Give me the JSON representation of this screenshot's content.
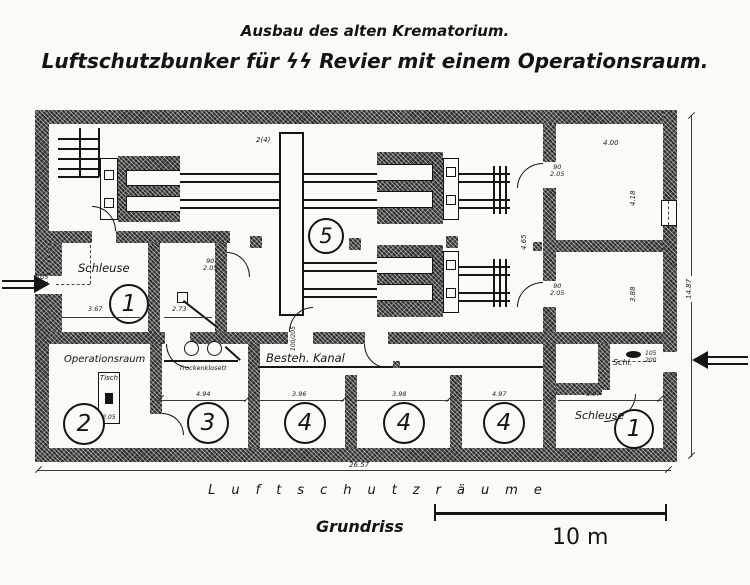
{
  "title": {
    "line1": "Ausbau des alten Krematorium.",
    "line2": "Luftschutzbunker für ϟϟ Revier mit einem Operationsraum."
  },
  "plan": {
    "rooms": [
      {
        "id": "schleuse-left",
        "label": "Schleuse",
        "number": "1",
        "dim": "3.67"
      },
      {
        "id": "operationsraum",
        "label": "Operationsraum",
        "number": "2",
        "furniture": "Tisch",
        "furniture_dim": "2.05"
      },
      {
        "id": "trockenklosett",
        "label": "Trockenklosett",
        "number": "3",
        "dim": "4.94"
      },
      {
        "id": "schutzraum-a",
        "number": "4",
        "dim": "3.96"
      },
      {
        "id": "schutzraum-b",
        "number": "4",
        "dim": "3.98"
      },
      {
        "id": "schutzraum-c",
        "number": "4",
        "dim": "4.97"
      },
      {
        "id": "schleuse-right",
        "label": "Schleuse",
        "number": "1",
        "dim": "5.97"
      },
      {
        "id": "ofenhalle",
        "number": "5",
        "note": "2(4)"
      }
    ],
    "closet_label": "Schl.",
    "kanal_label": "Besteh. Kanal",
    "small_room": {
      "dim": "2.73"
    },
    "right_rooms": {
      "top_w": "4.00",
      "top_h": "4.18",
      "mid_h": "3.88",
      "wall_dim": "4.65"
    },
    "doors": {
      "d90": "90",
      "d205": "2.05",
      "hall_door": "100/205",
      "left_w": "105",
      "left_h": "204",
      "right_w": "105",
      "right_h": "200"
    },
    "overall": {
      "width": "26.57",
      "height": "14.87"
    }
  },
  "footer": {
    "band": "Luftschutzräume",
    "caption": "Grundriss",
    "scale_label": "10 m"
  }
}
